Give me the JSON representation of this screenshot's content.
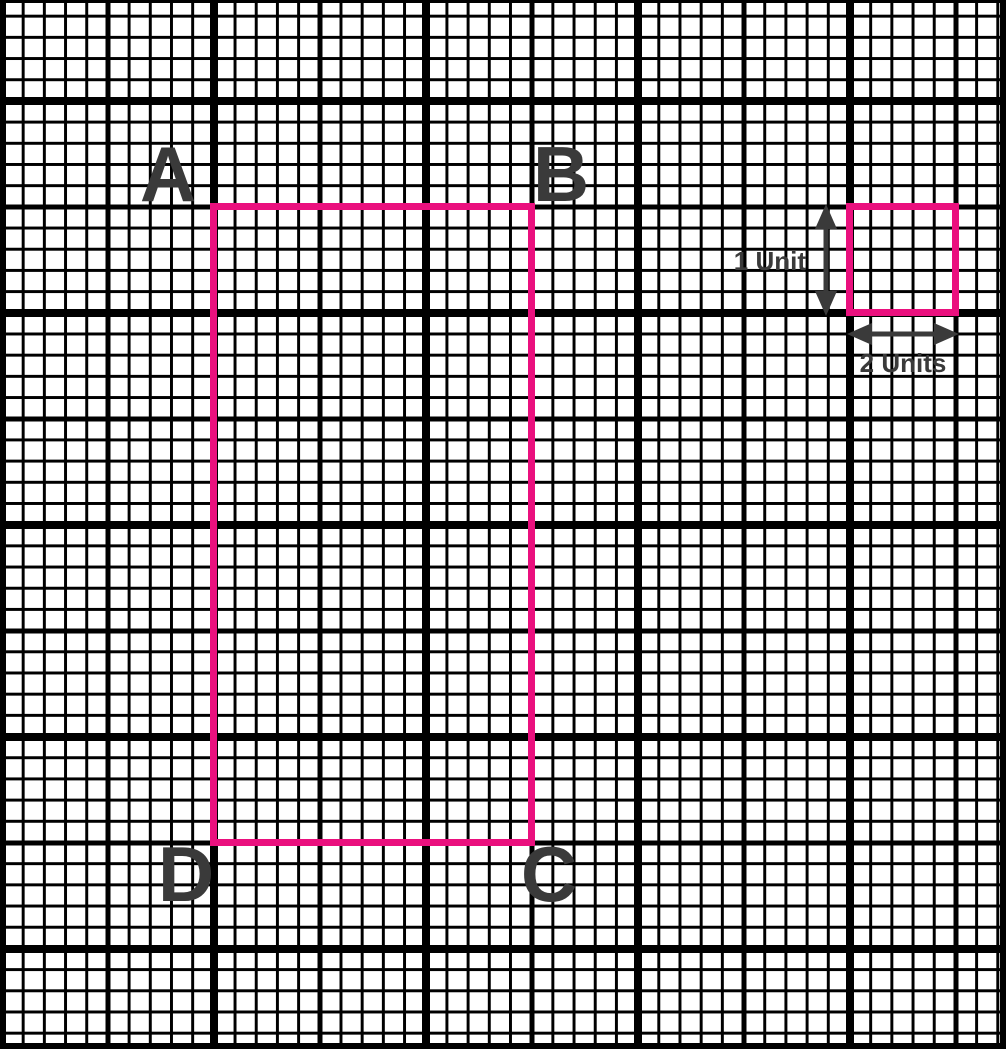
{
  "labels": {
    "corner_a": "A",
    "corner_b": "B",
    "corner_c": "C",
    "corner_d": "D",
    "vertical_scale": "1 Unit",
    "horizontal_scale": "2 Units"
  },
  "figure": {
    "shape": "rectangle",
    "corner_order": [
      "A",
      "B",
      "C",
      "D"
    ],
    "rectangle_span_small_cells": {
      "width": 15,
      "height": 30
    },
    "reference_square_span_small_cells": {
      "width": 5,
      "height": 5
    },
    "grid": {
      "small_cell_px": 21.2,
      "bold_line_every_cells": 5,
      "extra_bold_line_every_cells": 10
    }
  },
  "colors": {
    "accent": "#EA107E",
    "ink": "#3A3A3A",
    "grid": "#000000",
    "bg": "#FFFFFF"
  }
}
